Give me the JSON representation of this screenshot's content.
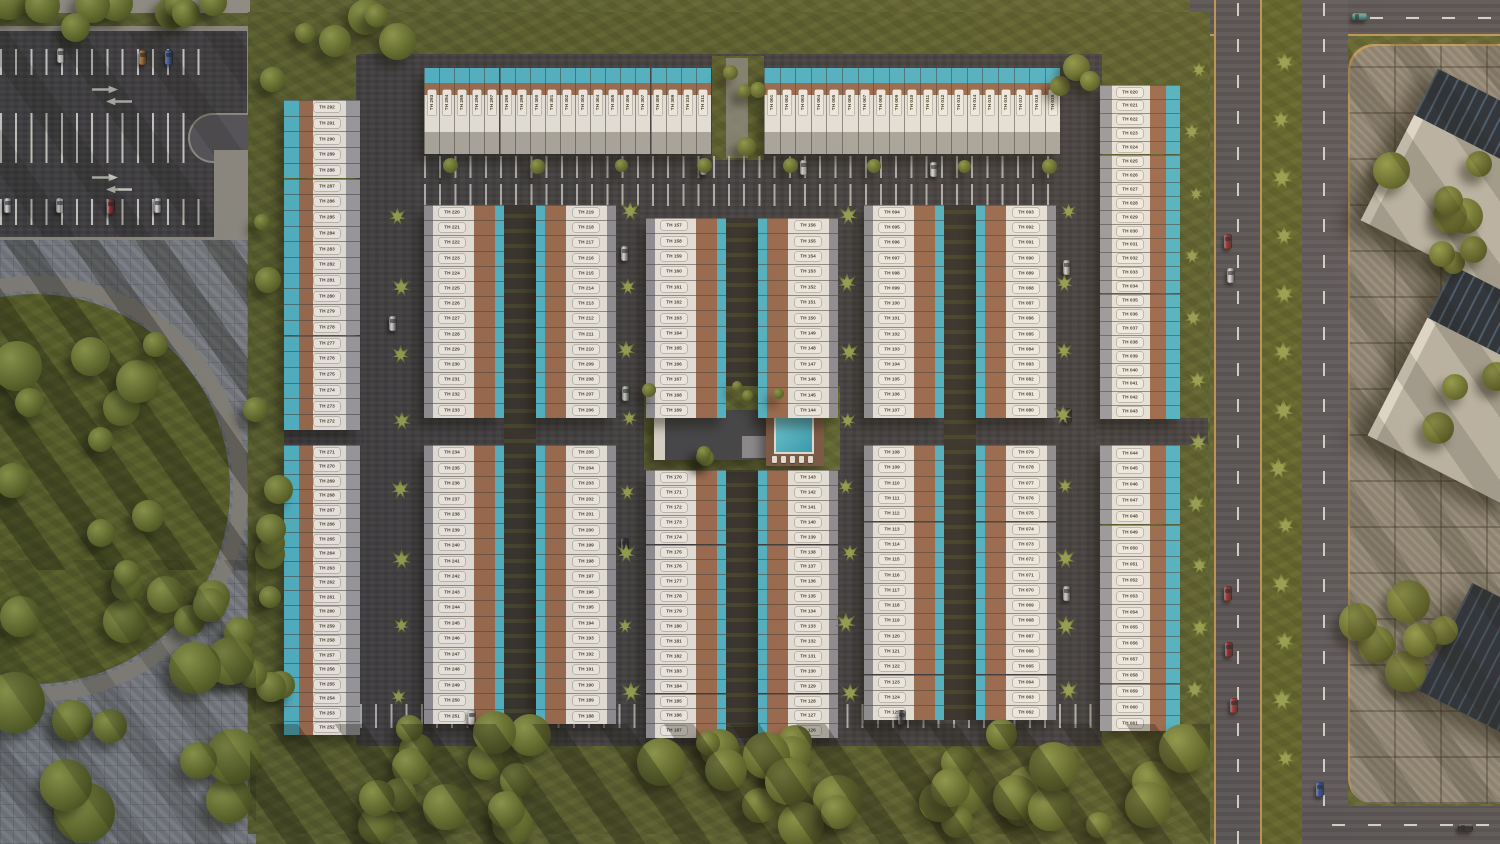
{
  "palette": {
    "lawn": "#5b6130",
    "asphalt": "#3c3b3e",
    "road": "#504e54",
    "pool": "#4fb6c9",
    "terracotta": "#9b6a4e",
    "roof_white": "#ebe8e1",
    "roof_back": "#9c9ca2",
    "carport": "#8f8f96",
    "carport2": "#aba9a1",
    "chip_bg": "#f4f1ea",
    "chip_text": "#47412f",
    "deck": "#7a5743",
    "club_roof": "#404247",
    "pool_water": "#3fb0c4",
    "paver_left": "#7a7e85",
    "paver_right": "#8d8678"
  },
  "units": {
    "prefix": "TH",
    "rows": [
      {
        "name": "outer-west-top",
        "kind": "west-outer",
        "x": 284,
        "y": 100,
        "pitch": 15.7,
        "count": 21,
        "start": 292,
        "step": -1
      },
      {
        "name": "outer-west-bottom",
        "kind": "west-outer",
        "x": 284,
        "y": 445,
        "pitch": 14.5,
        "count": 20,
        "start": 271,
        "step": -1
      },
      {
        "name": "outer-east-top",
        "kind": "east-outer",
        "x": 1100,
        "y": 85,
        "pitch": 13.9,
        "count": 24,
        "start": 20,
        "step": 1
      },
      {
        "name": "outer-east-bottom",
        "kind": "east-outer",
        "x": 1100,
        "y": 445,
        "pitch": 15.9,
        "count": 18,
        "start": 44,
        "step": 1
      },
      {
        "name": "north-left",
        "kind": "top-row",
        "x": 424,
        "y": 68,
        "pitch": 15.1,
        "count": 19,
        "start": 293,
        "step": 1
      },
      {
        "name": "north-right",
        "kind": "top-row",
        "x": 764,
        "y": 68,
        "pitch": 15.6,
        "count": 19,
        "start": 1,
        "step": 1
      },
      {
        "name": "block-a-west-top",
        "kind": "face-west",
        "x": 424,
        "y": 205,
        "pitch": 15.2,
        "count": 14,
        "start": 220,
        "step": 1
      },
      {
        "name": "block-a-east-top",
        "kind": "face-east",
        "x": 536,
        "y": 205,
        "pitch": 15.2,
        "count": 14,
        "start": 219,
        "step": -1
      },
      {
        "name": "block-a-west-bottom",
        "kind": "face-west",
        "x": 424,
        "y": 445,
        "pitch": 15.5,
        "count": 18,
        "start": 234,
        "step": 1
      },
      {
        "name": "block-a-east-bottom",
        "kind": "face-east",
        "x": 536,
        "y": 445,
        "pitch": 15.5,
        "count": 18,
        "start": 205,
        "step": -1
      },
      {
        "name": "block-b-west-top",
        "kind": "face-west",
        "x": 646,
        "y": 218,
        "pitch": 15.4,
        "count": 13,
        "start": 157,
        "step": 1
      },
      {
        "name": "block-b-east-top",
        "kind": "face-east",
        "x": 758,
        "y": 218,
        "pitch": 15.4,
        "count": 13,
        "start": 156,
        "step": -1
      },
      {
        "name": "block-b-west-bottom",
        "kind": "face-west",
        "x": 646,
        "y": 470,
        "pitch": 14.9,
        "count": 18,
        "start": 170,
        "step": 1
      },
      {
        "name": "block-b-east-bottom",
        "kind": "face-east",
        "x": 758,
        "y": 470,
        "pitch": 14.9,
        "count": 18,
        "start": 143,
        "step": -1
      },
      {
        "name": "block-c-west-top",
        "kind": "face-west",
        "x": 864,
        "y": 205,
        "pitch": 15.2,
        "count": 14,
        "start": 94,
        "step": 1
      },
      {
        "name": "block-c-east-top",
        "kind": "face-east",
        "x": 976,
        "y": 205,
        "pitch": 15.2,
        "count": 14,
        "start": 93,
        "step": -1
      },
      {
        "name": "block-c-west-bottom",
        "kind": "face-west",
        "x": 864,
        "y": 445,
        "pitch": 15.3,
        "count": 18,
        "start": 108,
        "step": 1
      },
      {
        "name": "block-c-east-bottom",
        "kind": "face-east",
        "x": 976,
        "y": 445,
        "pitch": 15.3,
        "count": 18,
        "start": 79,
        "step": -1
      }
    ]
  },
  "cars": [
    {
      "x": 57,
      "y": 48,
      "o": "v",
      "c": "#dcdcd8"
    },
    {
      "x": 139,
      "y": 50,
      "o": "v",
      "c": "#b06a28"
    },
    {
      "x": 165,
      "y": 50,
      "o": "v",
      "c": "#3858a8"
    },
    {
      "x": 4,
      "y": 198,
      "o": "v",
      "c": "#e0e0dc"
    },
    {
      "x": 56,
      "y": 198,
      "o": "v",
      "c": "#c2c2be"
    },
    {
      "x": 107,
      "y": 199,
      "o": "v",
      "c": "#9c2424"
    },
    {
      "x": 154,
      "y": 198,
      "o": "v",
      "c": "#e4e4e0"
    },
    {
      "x": 700,
      "y": 160,
      "o": "v",
      "c": "#dcdcd8"
    },
    {
      "x": 800,
      "y": 160,
      "o": "v",
      "c": "#d0d0cc"
    },
    {
      "x": 930,
      "y": 162,
      "o": "v",
      "c": "#e0e0dc"
    },
    {
      "x": 389,
      "y": 316,
      "o": "v",
      "c": "#d8d8d4"
    },
    {
      "x": 621,
      "y": 246,
      "o": "v",
      "c": "#d8d8d4"
    },
    {
      "x": 622,
      "y": 386,
      "o": "v",
      "c": "#caccc8"
    },
    {
      "x": 621,
      "y": 538,
      "o": "v",
      "c": "#2a2a2e"
    },
    {
      "x": 1063,
      "y": 260,
      "o": "v",
      "c": "#d8d8d4"
    },
    {
      "x": 1064,
      "y": 408,
      "o": "v",
      "c": "#2e2e32"
    },
    {
      "x": 1063,
      "y": 586,
      "o": "v",
      "c": "#d4d4d0"
    },
    {
      "x": 468,
      "y": 710,
      "o": "v",
      "c": "#d8d8d4"
    },
    {
      "x": 482,
      "y": 752,
      "o": "h",
      "c": "#c09a30"
    },
    {
      "x": 898,
      "y": 710,
      "o": "v",
      "c": "#303034"
    },
    {
      "x": 1224,
      "y": 234,
      "o": "v",
      "c": "#a02828"
    },
    {
      "x": 1227,
      "y": 268,
      "o": "v",
      "c": "#e0e0de"
    },
    {
      "x": 1224,
      "y": 586,
      "o": "v",
      "c": "#a02828"
    },
    {
      "x": 1225,
      "y": 642,
      "o": "v",
      "c": "#902020"
    },
    {
      "x": 1230,
      "y": 698,
      "o": "v",
      "c": "#a83030"
    },
    {
      "x": 1352,
      "y": 13,
      "o": "h",
      "c": "#48a8a0"
    },
    {
      "x": 1316,
      "y": 782,
      "o": "v",
      "c": "#2848b0"
    },
    {
      "x": 1458,
      "y": 824,
      "o": "h",
      "c": "#26262a"
    }
  ]
}
